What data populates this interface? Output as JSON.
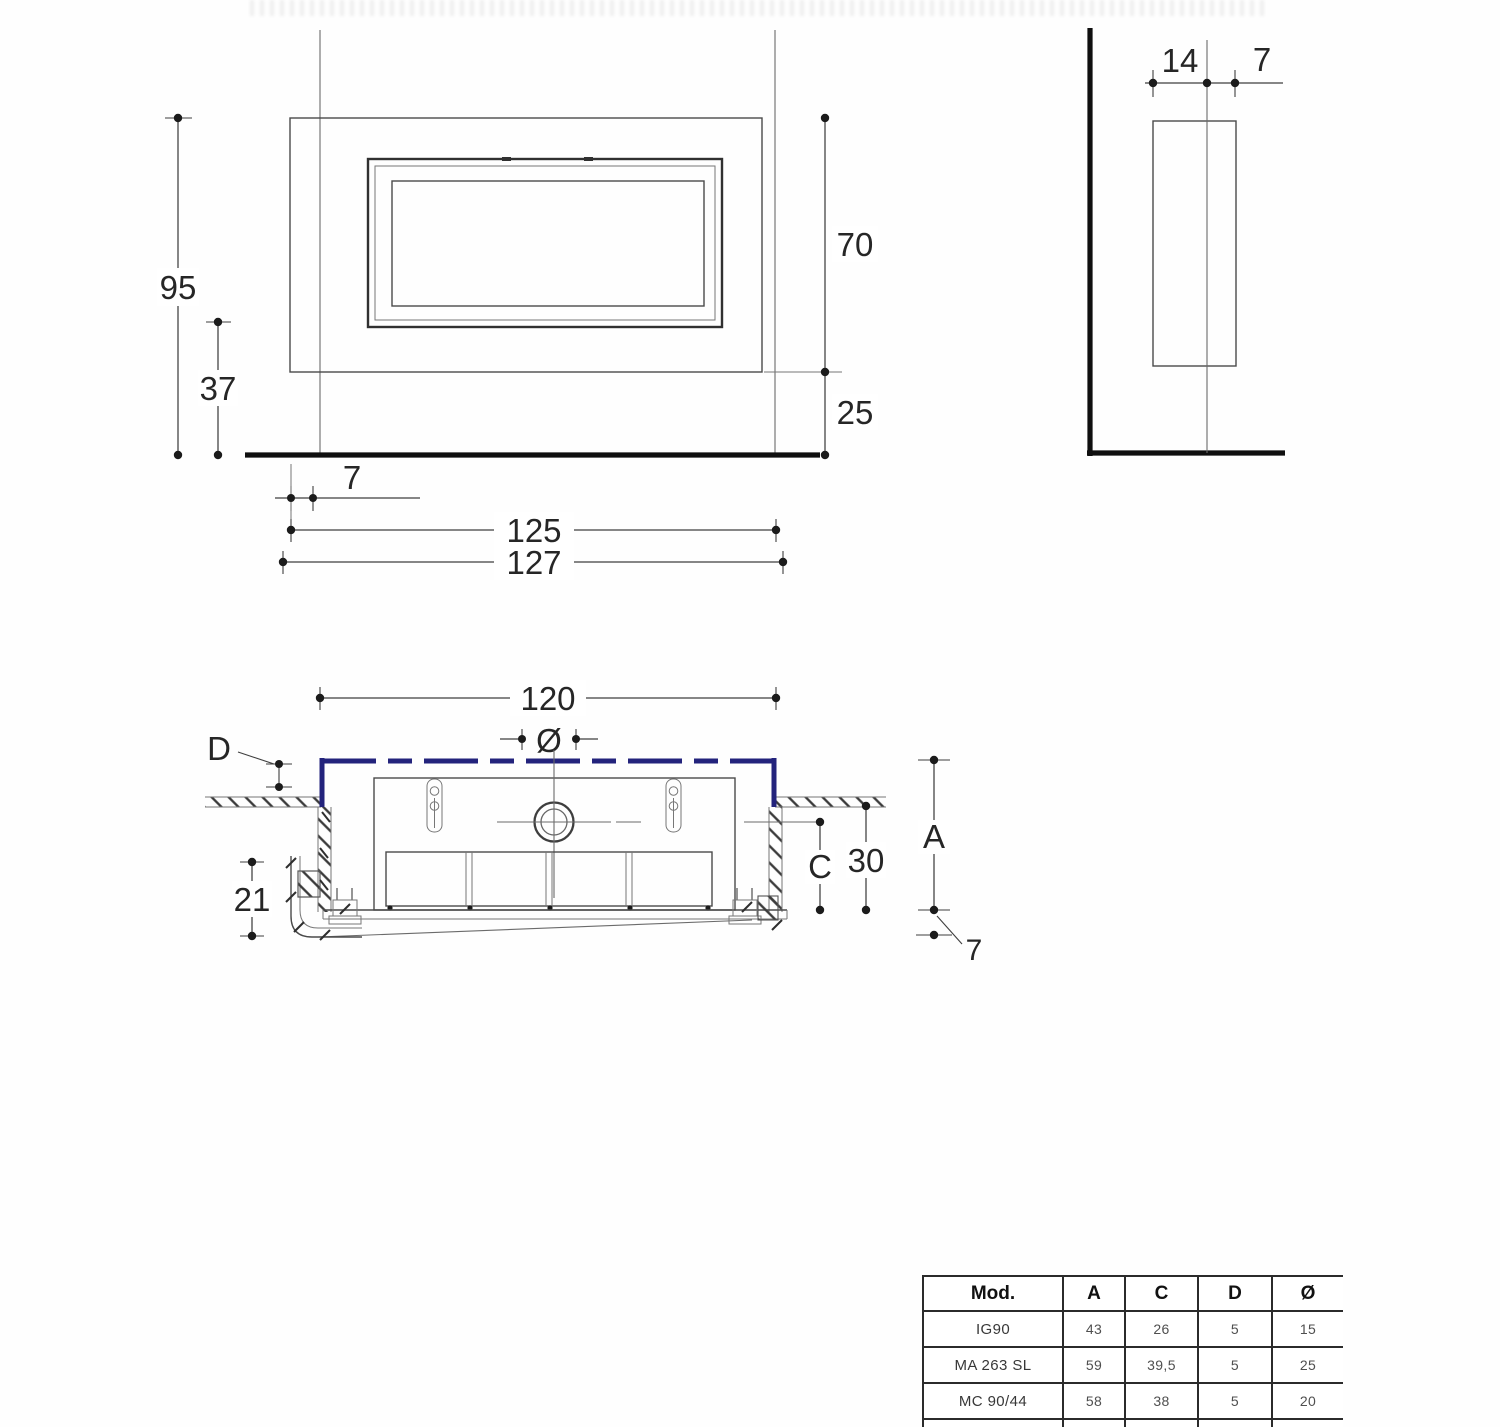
{
  "colors": {
    "accent_blue": "#23237c",
    "line_dark": "#111111",
    "line_mid": "#4a4a4a"
  },
  "front_view": {
    "height_total": "95",
    "height_lower": "37",
    "height_opening": "70",
    "height_base": "25",
    "side_offset": "7",
    "width_inner": "125",
    "width_outer": "127"
  },
  "side_view": {
    "depth_recessed": "14",
    "depth_proud": "7"
  },
  "plan_view": {
    "niche_width": "120",
    "flue_diameter_symbol": "Ø",
    "label_d": "D",
    "label_c": "C",
    "niche_depth": "30",
    "label_a": "A",
    "frame_depth": "21",
    "front_offset": "7"
  },
  "table": {
    "headers": [
      "Mod.",
      "A",
      "C",
      "D",
      "Ø"
    ],
    "rows": [
      [
        "IG90",
        "43",
        "26",
        "5",
        "15"
      ],
      [
        "MA 263 SL",
        "59",
        "39,5",
        "5",
        "25"
      ],
      [
        "MC 90/44",
        "58",
        "38",
        "5",
        "20"
      ]
    ]
  }
}
